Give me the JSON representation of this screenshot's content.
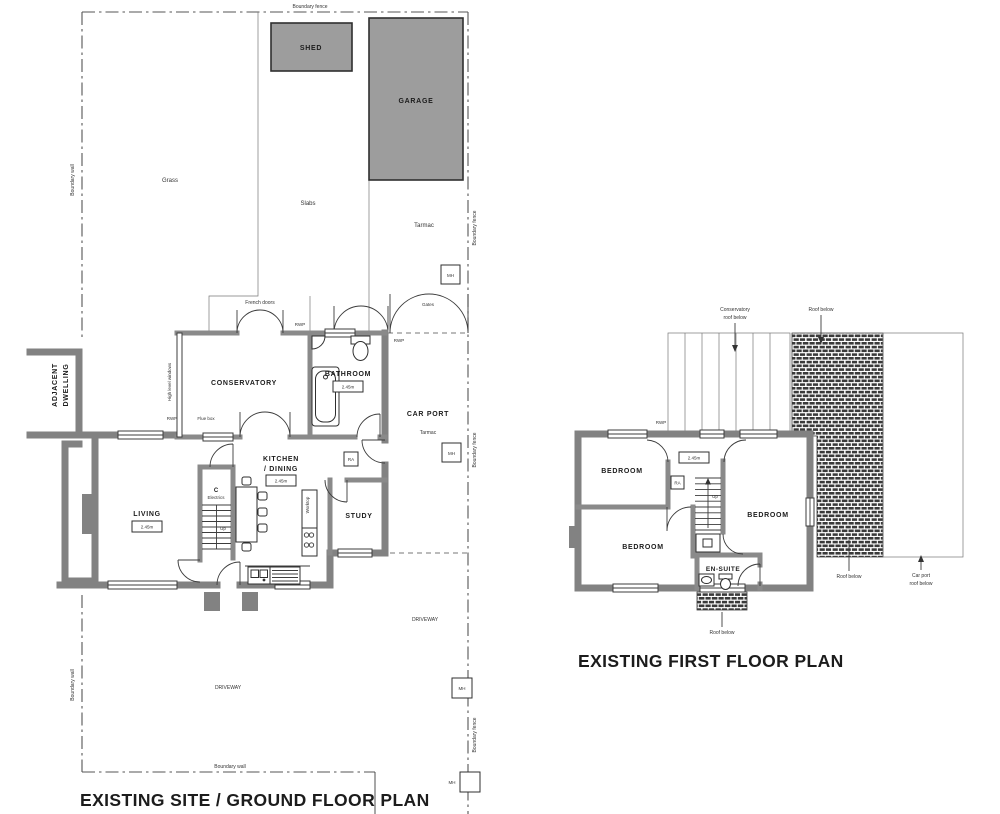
{
  "colors": {
    "wall_gray": "#828282",
    "outbuilding_fill": "#9d9d9d",
    "line_dark": "#2f2f2f",
    "paper": "#ffffff"
  },
  "titles": {
    "ground_floor": "EXISTING SITE / GROUND FLOOR PLAN",
    "first_floor": "EXISTING FIRST FLOOR PLAN"
  },
  "site": {
    "boundary_fence": "Boundary fence",
    "boundary_wall": "Boundary wall",
    "grass": "Grass",
    "slabs": "Slabs",
    "tarmac": "Tarmac",
    "gates": "Gates",
    "driveway": "DRIVEWAY",
    "manhole": "MH",
    "shed": "SHED",
    "garage": "GARAGE",
    "adjacent_line1": "ADJACENT",
    "adjacent_line2": "DWELLING",
    "car_port": "CAR PORT"
  },
  "ground_rooms": {
    "conservatory": "CONSERVATORY",
    "bathroom": "BATHROOM",
    "kitchen_line1": "KITCHEN",
    "kitchen_line2": "/ DINING",
    "living": "LIVING",
    "study": "STUDY",
    "cupboard": "C",
    "electrics": "Electrics",
    "up": "Up",
    "worktop": "Worktop",
    "french_doors": "French doors",
    "high_level_windows": "High level windows",
    "flue_box": "Flue box",
    "rwp": "RWP",
    "radiator": "RA",
    "ceiling_height": "2.45m"
  },
  "first_rooms": {
    "bedroom": "BEDROOM",
    "en_suite": "EN-SUITE",
    "up": "Up",
    "rwp": "RWP",
    "radiator": "RA",
    "ceiling_height": "2.45m",
    "conservatory_roof_line1": "Conservatory",
    "conservatory_roof_line2": "roof below",
    "roof_below": "Roof below",
    "carport_roof_line1": "Car port",
    "carport_roof_line2": "roof below"
  }
}
